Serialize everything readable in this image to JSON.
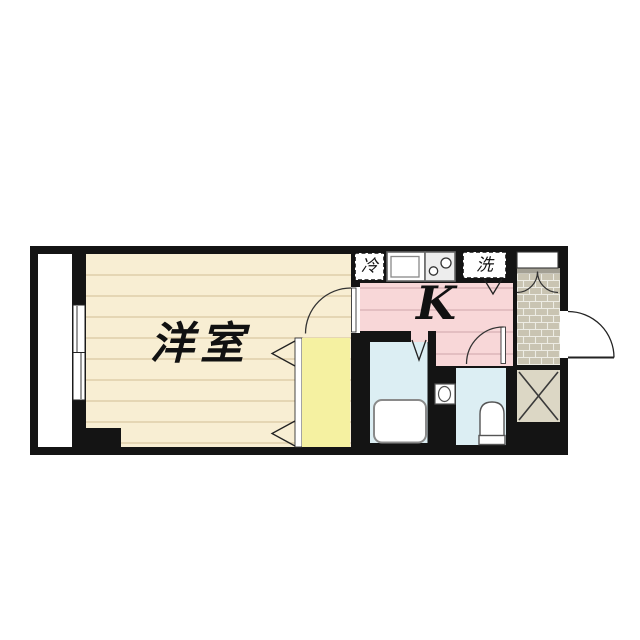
{
  "title": "apartment-floor-plan",
  "labels": {
    "western_room": "洋室",
    "kitchen": "K",
    "refrigerator": "冷",
    "washer": "洗"
  },
  "colors": {
    "wall": "#141414",
    "background": "#ffffff",
    "western_room_floor": "#f8eed3",
    "floor_line": "#d9c8a2",
    "kitchen_fill": "#f8d7d8",
    "kitchen_line": "#d6aeb3",
    "closet_fill": "#f5f1a1",
    "wet_area_fill": "#dceef3",
    "tile_brick": "#c9c4b2",
    "tile_joint": "#edece4",
    "tile_band": "#a3a094",
    "shaft_fill": "#dcd7c5",
    "fixture_fill": "#ffffff",
    "stove_fill": "#ededed",
    "line_dark": "#222222"
  }
}
